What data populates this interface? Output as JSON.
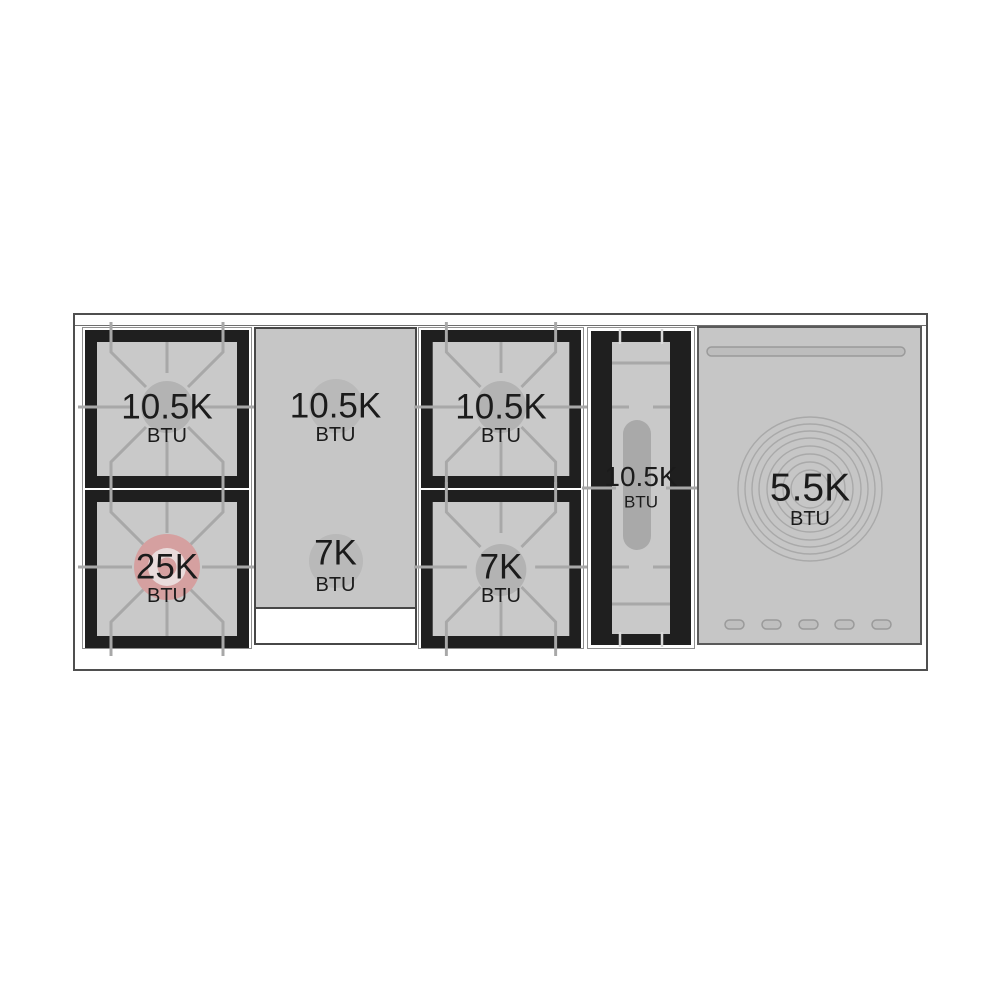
{
  "diagram": {
    "type": "range-cooktop-btu-layout",
    "sections": {
      "left_rear": {
        "power": "10.5K",
        "unit": "BTU"
      },
      "left_front": {
        "power": "25K",
        "unit": "BTU"
      },
      "griddle_rear": {
        "power": "10.5K",
        "unit": "BTU"
      },
      "griddle_front": {
        "power": "7K",
        "unit": "BTU"
      },
      "center_rear": {
        "power": "10.5K",
        "unit": "BTU"
      },
      "center_front": {
        "power": "7K",
        "unit": "BTU"
      },
      "oval_burner": {
        "power": "10.5K",
        "unit": "BTU"
      },
      "simmer_plate": {
        "power": "5.5K",
        "unit": "BTU"
      }
    },
    "colors": {
      "burner_frame": "#1f1f1f",
      "surface_gray": "#c9c9c9",
      "griddle_gray": "#c6c6c6",
      "grate_line": "#a8a8a8",
      "burner_cap_gray": "#b3b3b3",
      "highlight_burner_pink": "#d5a0a0",
      "highlight_inner_ring": "#e9dbdb",
      "outline_dark": "#4f4f4f"
    }
  }
}
